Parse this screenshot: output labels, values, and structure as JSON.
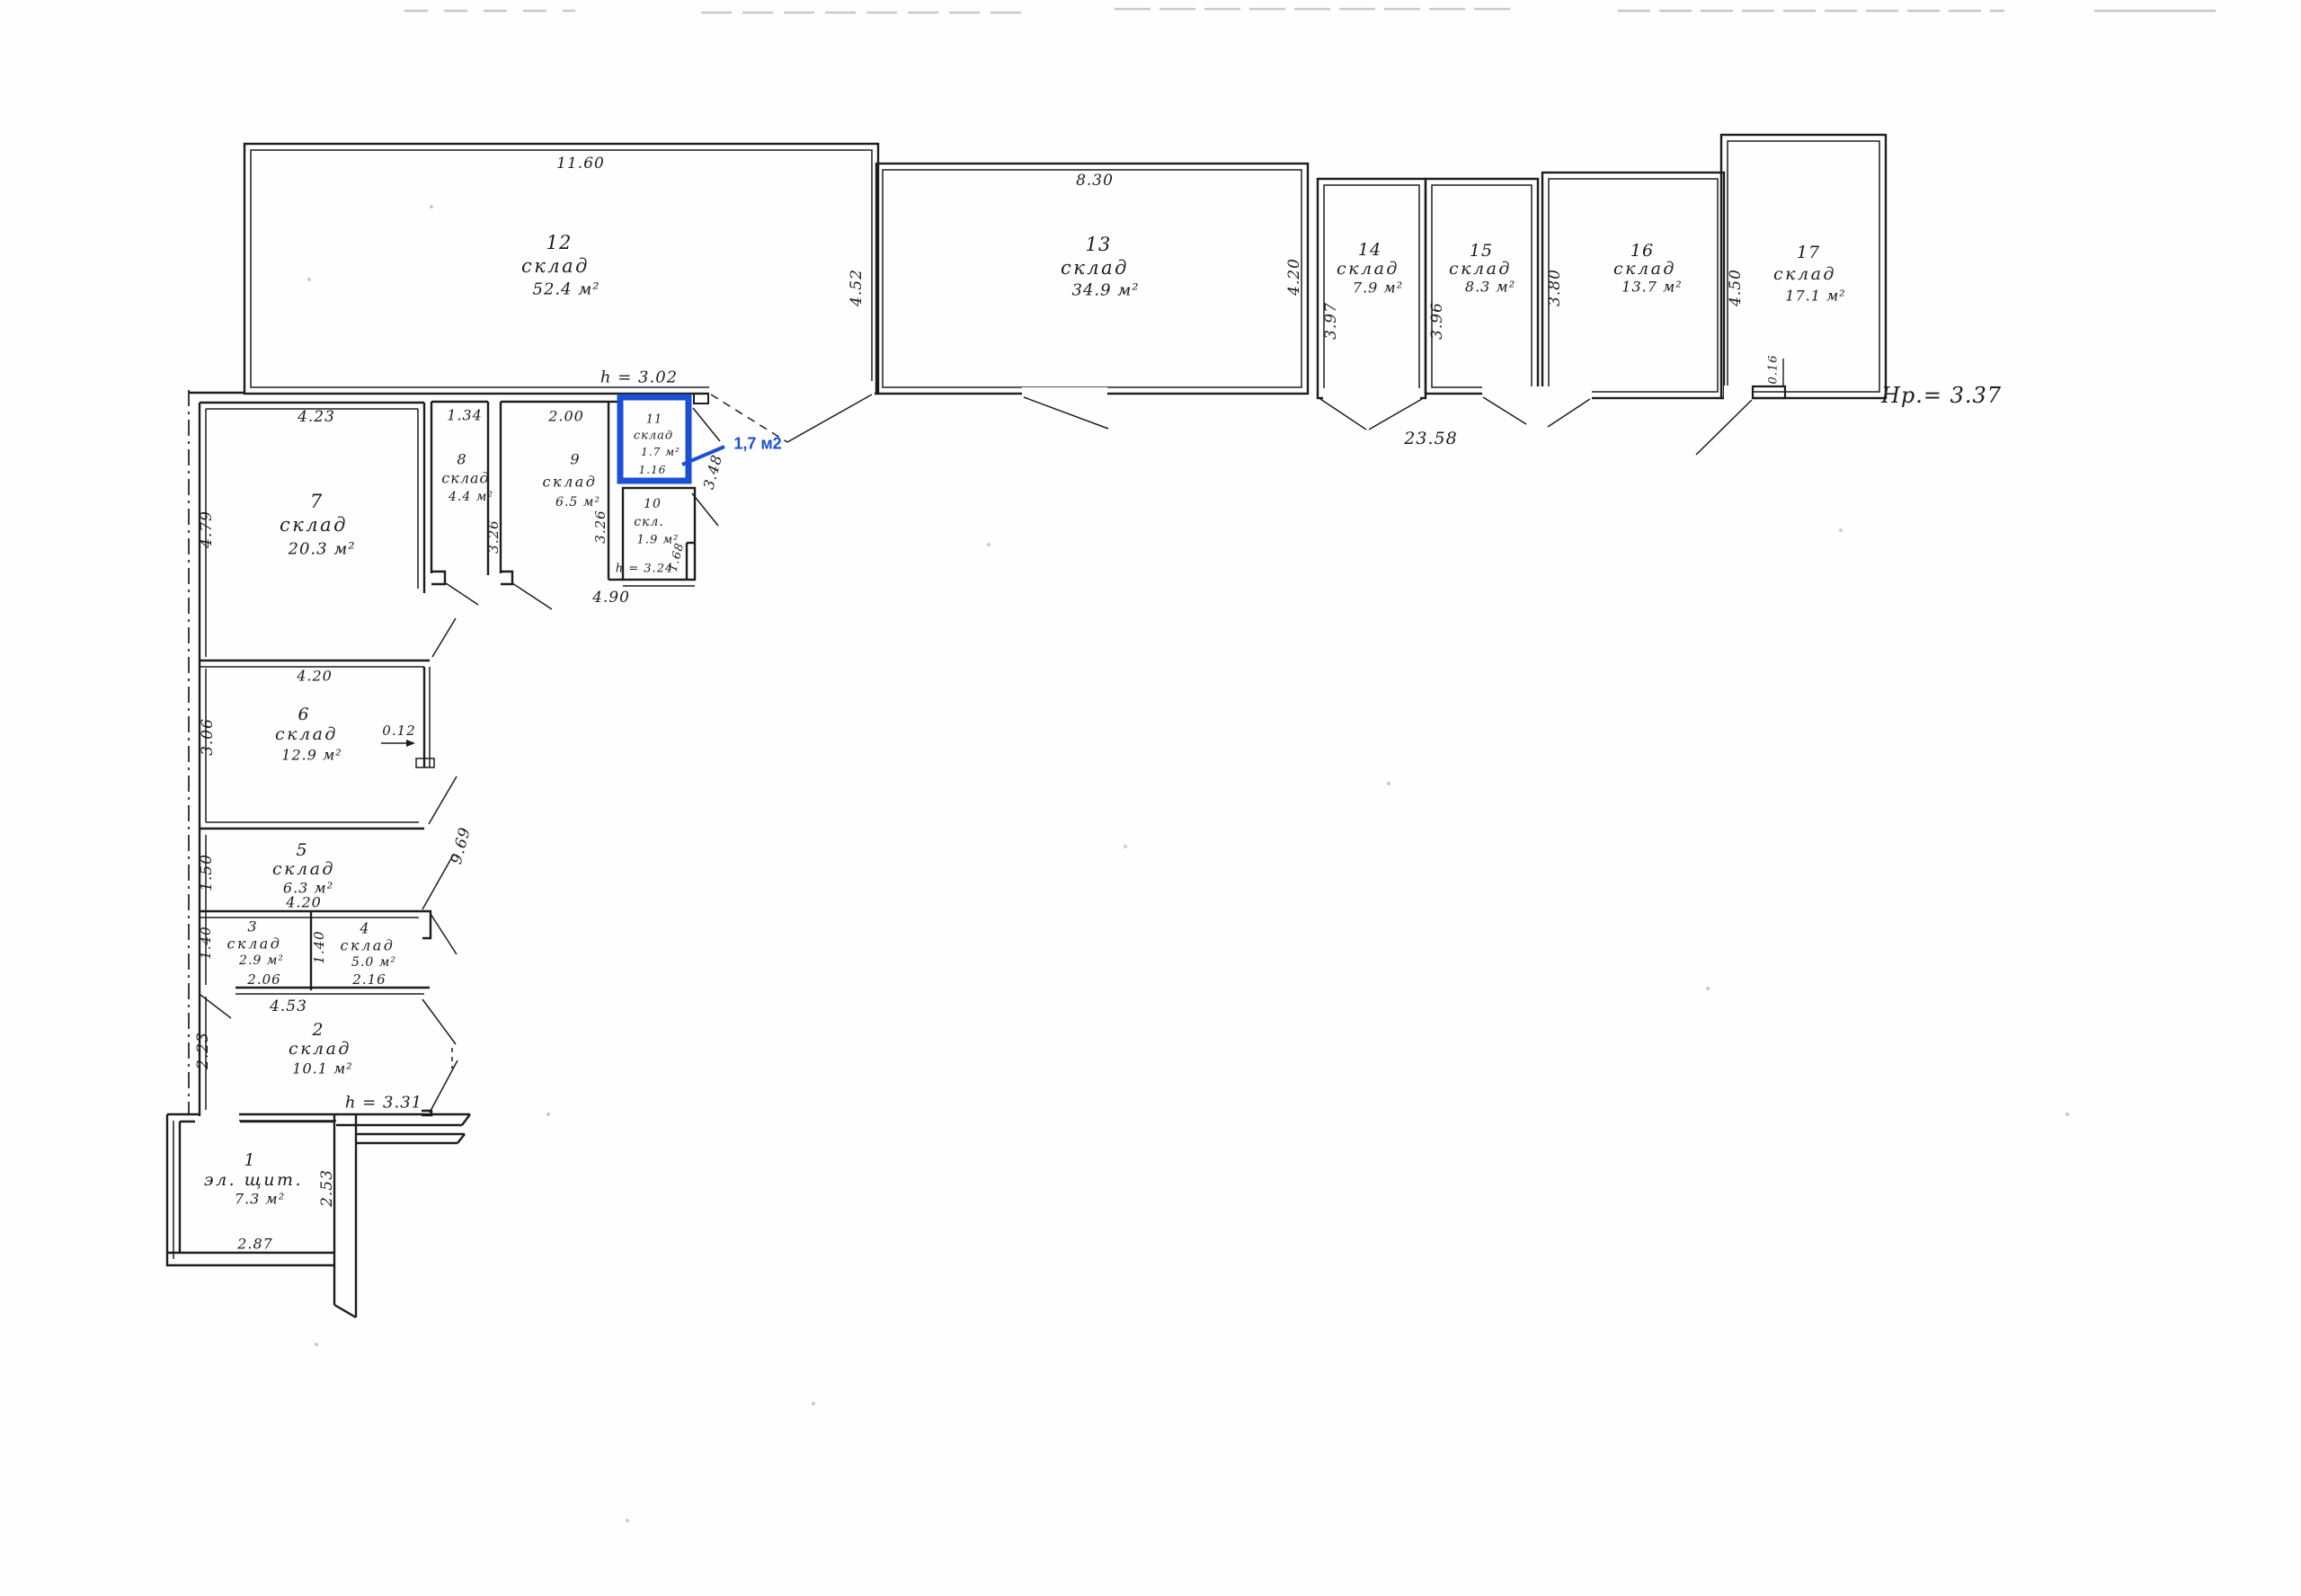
{
  "title": "Поэтажный план склада",
  "building": {
    "height_note": "Нр.= 3.37"
  },
  "heights": {
    "r12": "h = 3.02",
    "r10": "h = 3.24",
    "r2": "h = 3.31"
  },
  "annotation": {
    "area": "1,7 м2",
    "color": "#1b4fd6"
  },
  "rooms": [
    {
      "num": "1",
      "name": "эл. щит.",
      "area": "7.3 м²"
    },
    {
      "num": "2",
      "name": "склад",
      "area": "10.1 м²"
    },
    {
      "num": "3",
      "name": "склад",
      "area": "2.9 м²"
    },
    {
      "num": "4",
      "name": "склад",
      "area": "5.0 м²"
    },
    {
      "num": "5",
      "name": "склад",
      "area": "6.3 м²"
    },
    {
      "num": "6",
      "name": "склад",
      "area": "12.9 м²"
    },
    {
      "num": "7",
      "name": "склад",
      "area": "20.3 м²"
    },
    {
      "num": "8",
      "name": "склад",
      "area": "4.4 м²"
    },
    {
      "num": "9",
      "name": "склад",
      "area": "6.5 м²"
    },
    {
      "num": "10",
      "name": "скл.",
      "area": "1.9 м²"
    },
    {
      "num": "11",
      "name": "склад",
      "area": "1.7 м²"
    },
    {
      "num": "12",
      "name": "склад",
      "area": "52.4 м²"
    },
    {
      "num": "13",
      "name": "склад",
      "area": "34.9 м²"
    },
    {
      "num": "14",
      "name": "склад",
      "area": "7.9 м²"
    },
    {
      "num": "15",
      "name": "склад",
      "area": "8.3 м²"
    },
    {
      "num": "16",
      "name": "склад",
      "area": "13.7 м²"
    },
    {
      "num": "17",
      "name": "склад",
      "area": "17.1 м²"
    }
  ],
  "dims": {
    "r12_top": "11.60",
    "r12_right": "4.52",
    "r13_top": "8.30",
    "r13_right": "4.20",
    "r14_left": "3.97",
    "r15_left": "3.96",
    "r16_left": "3.80",
    "r17_left": "4.50",
    "r17_wall": "0.16",
    "bottom_span": "23.58",
    "r7_top": "4.23",
    "r8_top": "1.34",
    "r9_top": "2.00",
    "r11_width": "1.16",
    "corridor_diag": "3.48",
    "r7_left": "4.79",
    "r8_height": "3.26",
    "r9_height": "3.26",
    "r10_wall": "1.68",
    "r10_bottom": "4.90",
    "r6_top": "4.20",
    "r6_left": "3.06",
    "r6_stub": "0.12",
    "r5_left": "1.50",
    "r5_bottom": "4.20",
    "diag_span": "9.69",
    "r3_left": "1.40",
    "r4_left": "1.40",
    "r3_bottom": "2.06",
    "r4_bottom": "2.16",
    "r34_span": "4.53",
    "r2_left": "2.23",
    "r1_right": "2.53",
    "r1_bottom": "2.87"
  }
}
